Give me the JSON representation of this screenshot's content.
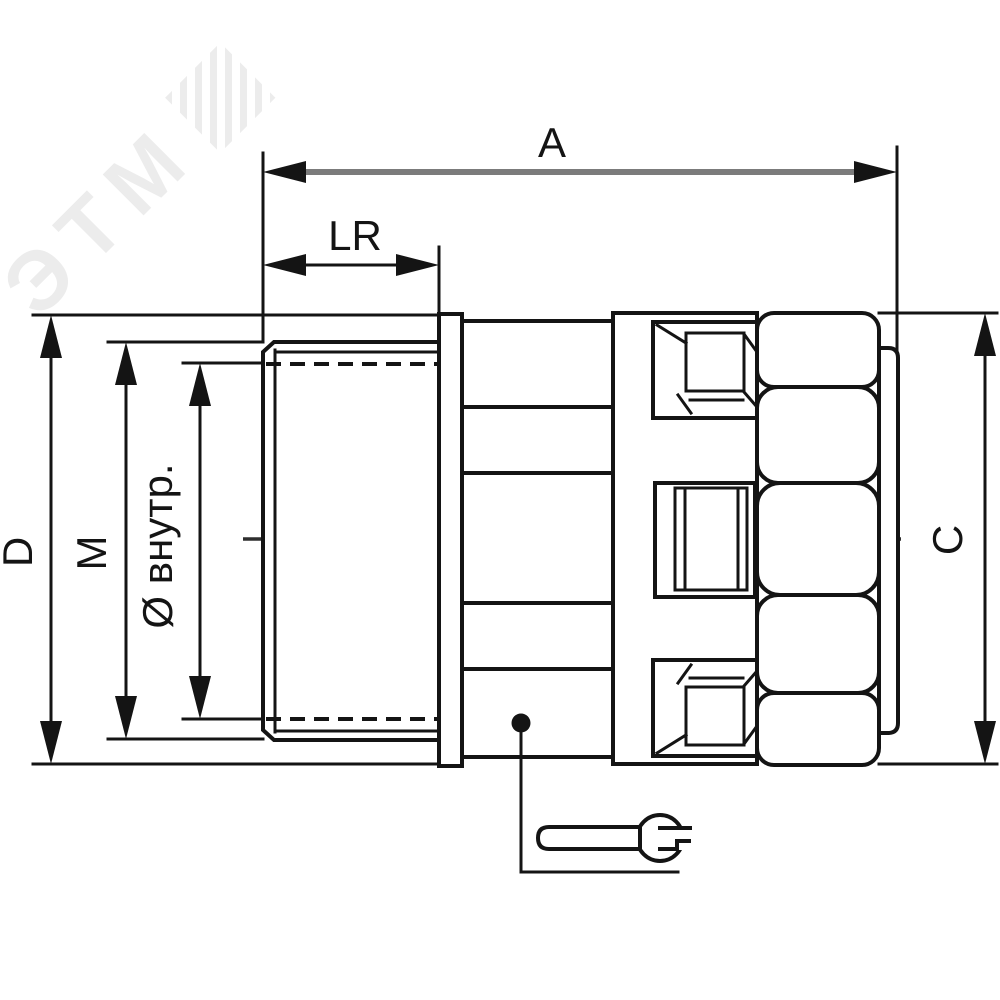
{
  "drawing": {
    "type": "engineering-dimension-drawing",
    "subject": "threaded-conduit-fitting-side-view",
    "watermark": "ЭТМ",
    "labels": {
      "overall_length": "A",
      "thread_length": "LR",
      "flange_outer_diameter": "D",
      "thread_diameter": "M",
      "inner_diameter": "Ø внутр.",
      "nut_across_size": "C"
    },
    "icons": {
      "wrench": "open-end-wrench-icon",
      "watermark_logo": "striped-square-logo"
    },
    "colors": {
      "background": "#ffffff",
      "outline": "#141414",
      "dimension_line_gray": "#7b7b7b",
      "watermark": "#ececec"
    }
  }
}
